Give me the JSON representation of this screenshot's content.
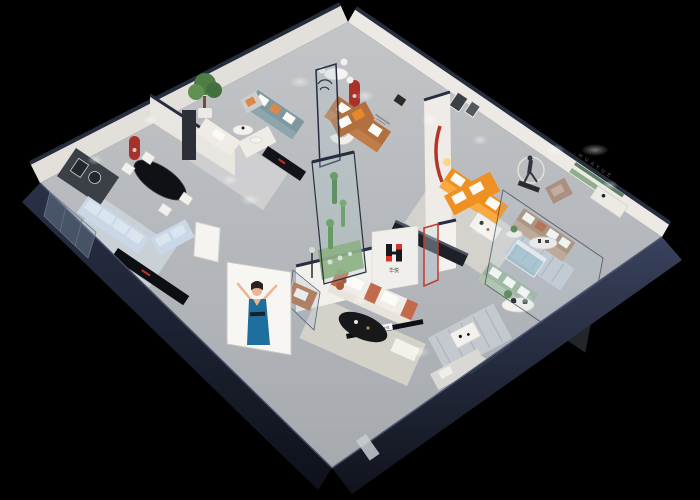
{
  "scene": {
    "type": "3D isometric cutaway render",
    "description": "Top-down isometric 3D render of a furniture brand showroom with multiple room displays, dark navy exterior walls and a black background",
    "background_color": "#000000"
  },
  "brand": {
    "logo_mark": "H-blocks-red-black",
    "name_cn": "华悦",
    "wall_letters": "HUAYUE"
  },
  "colors": {
    "exterior_wall_navy": "#232a3d",
    "interior_wall": "#efece7",
    "floor_gray": "#b6b9bd",
    "accent_red": "#a8322a",
    "logo_red": "#d63426",
    "logo_black": "#17181c",
    "orange_sofa": "#f08f1d",
    "caramel_sofa": "#b26f3f",
    "teal_sofa": "#7e98a2",
    "pale_blue_sofa": "#cad7e6",
    "mocha_sofa": "#a98a72",
    "sage_sofa": "#9cb29c",
    "terracotta_sofa": "#c26a4b",
    "plant_green": "#4e7d46",
    "billboard_dress_blue": "#1e6f9d"
  },
  "rooms": [
    {
      "id": "living-dining-left",
      "items": "black oval dining table with four white chairs, pale blue sectional sofa, dark TV wall, black media console, red arched wall niche"
    },
    {
      "id": "lounge-top-left",
      "items": "potted tree, teal sofa, cream chaise sofa, grey armchair, white coffee tables, black media console"
    },
    {
      "id": "reception-center",
      "items": "round white dining table with chairs, curved white sofa, caramel leather sofa with orange pillows, red arched niche, wall slogan"
    },
    {
      "id": "orange-showroom",
      "items": "orange L-shaped sectional with white pillows, white coffee table, walking-figure sculpture with light ring, wall art frames"
    },
    {
      "id": "huayue-wall-right",
      "items": "HUAYUE lettering with green shelf strips, mocha leather sofa, striped rug, side table with plant"
    },
    {
      "id": "glass-displays-right",
      "items": "glass partition, teal glass cabinet, sage green sofa, round table with black swan decor"
    },
    {
      "id": "living-display-bottom",
      "items": "white and terracotta sofa, black oval coffee table, white ottoman, caramel armchair, black display rail with brand sign"
    },
    {
      "id": "plant-case-center",
      "items": "curved glass enclosure with green plants and figurine"
    },
    {
      "id": "brand-wall-center",
      "items": "red and black H logo with Chinese brand name"
    },
    {
      "id": "billboard-exterior",
      "items": "white billboard with illustrated woman in blue dress"
    },
    {
      "id": "lounge-bottom-right",
      "items": "white table, striped rug, light grey sofa"
    }
  ]
}
